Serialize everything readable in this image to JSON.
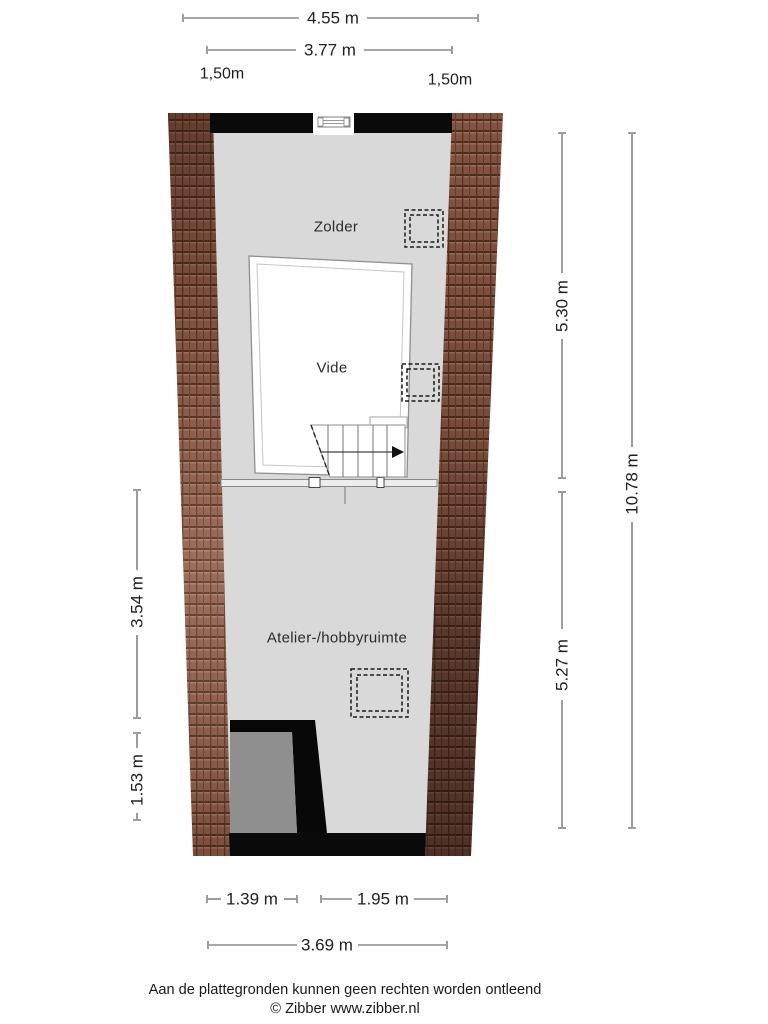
{
  "plan": {
    "rooms": {
      "zolder": "Zolder",
      "vide": "Vide",
      "atelier": "Atelier-/hobbyruimte"
    },
    "dimensions": {
      "top_outer": "4.55 m",
      "top_inner": "3.77 m",
      "knee_left": "1,50m",
      "knee_right": "1,50m",
      "right_upper": "5.30 m",
      "right_lower": "5.27 m",
      "right_total": "10.78 m",
      "left_upper": "3.54 m",
      "left_lower": "1.53 m",
      "bottom_left": "1.39 m",
      "bottom_right": "1.95 m",
      "bottom_total": "3.69 m"
    },
    "footer": {
      "disclaimer": "Aan de plattegronden kunnen geen rechten worden ontleend",
      "copyright": "© Zibber www.zibber.nl"
    },
    "colors": {
      "floor": "#d9d9d9",
      "wall": "#0a0a0a",
      "roof_tile": "#8e5c4a",
      "dark_room": "#8f8f8f",
      "vide_fill": "#ffffff",
      "dimension_line": "#4d4d4d"
    }
  }
}
